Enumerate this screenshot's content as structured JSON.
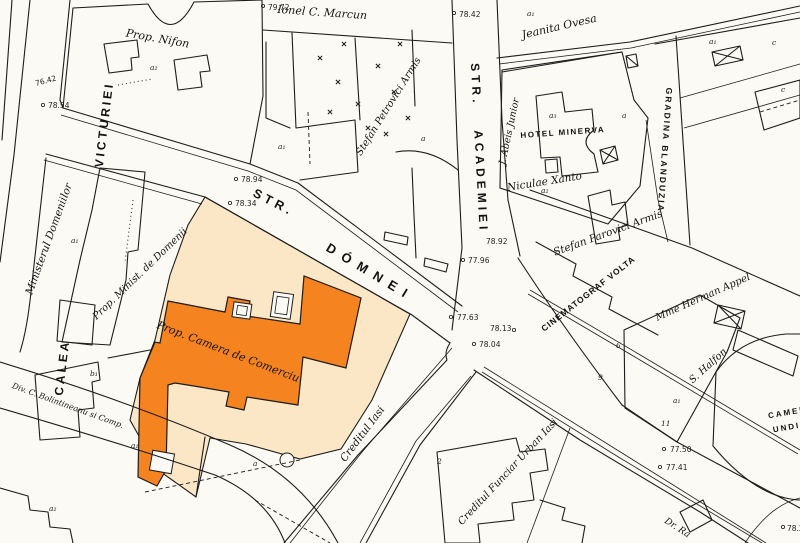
{
  "colors": {
    "background": "#fbfaf4",
    "ink": "#1c1c1c",
    "parcel_cream": "#fbe7c5",
    "building_orange": "#f5831f",
    "label_on_building": "#ffffff"
  },
  "streets": {
    "calea_line1": "CALEA",
    "calea_line2": "VICTURIEI",
    "domnei_prefix": "STR.",
    "domnei_name": "DÓMNEI",
    "academiei_prefix": "STR.",
    "academiei_name": "ACADEMIEI"
  },
  "places": {
    "prop_nifon": "Prop. Nifon",
    "ionel_marcun": "Ionel C. Marcun",
    "jeanita_ovesa": "Jeanita Ovesa",
    "abeis_junior": "J. Abeis Junior",
    "hotel_minerva": "HOTEL MINERVA",
    "gradina_blanduzia": "GRADINA BLANDUZIA",
    "stefan_petrovici_armis_n": "Stefan Petrovici Armis",
    "niculae_xanto": "Niculae Xanto",
    "stefan_parovici_armis_e": "Stefan Parovici Armis",
    "cinematograf_volta": "CINEMATOGRAF VOLTA",
    "mme_herman_appel": "Mme Herman Appel",
    "s_halfon": "S. Halfon",
    "camer_partial": "CAMER",
    "undi_partial": "UNDI",
    "ministerul_domeniilor": "Ministerul Domeniilor",
    "prop_minist_domenii": "Prop. Minist. de Domenii",
    "camera_comerciu": "Prop. Camera de Comerciu",
    "creditul_iasi": "Creditul Iasi",
    "creditul_funciar": "Creditul Funciar Urban Iasi",
    "bolintineanu": "Div. C. Bolintineanu si Comp.",
    "dr_partial": "Dr. Ra"
  },
  "elevations": [
    {
      "value": "79.72"
    },
    {
      "value": "78.42"
    },
    {
      "value": "76.42"
    },
    {
      "value": "78.54"
    },
    {
      "value": "78.94"
    },
    {
      "value": "78.34"
    },
    {
      "value": "78.92"
    },
    {
      "value": "77.96"
    },
    {
      "value": "77.63"
    },
    {
      "value": "78.13"
    },
    {
      "value": "78.04"
    },
    {
      "value": "77.50"
    },
    {
      "value": "77.41"
    },
    {
      "value": "78.2"
    }
  ],
  "marks": [
    {
      "value": "a₂"
    },
    {
      "value": "a₁"
    },
    {
      "value": "a₃"
    },
    {
      "value": "a"
    },
    {
      "value": "a₁"
    },
    {
      "value": "c"
    },
    {
      "value": "c"
    },
    {
      "value": "a₂"
    },
    {
      "value": "a₁"
    },
    {
      "value": "a"
    },
    {
      "value": "a₁"
    },
    {
      "value": "b₁"
    },
    {
      "value": "a₁"
    },
    {
      "value": "a"
    },
    {
      "value": "a₂"
    },
    {
      "value": "9"
    },
    {
      "value": "6"
    },
    {
      "value": "11"
    },
    {
      "value": "a₁"
    },
    {
      "value": "2"
    }
  ]
}
